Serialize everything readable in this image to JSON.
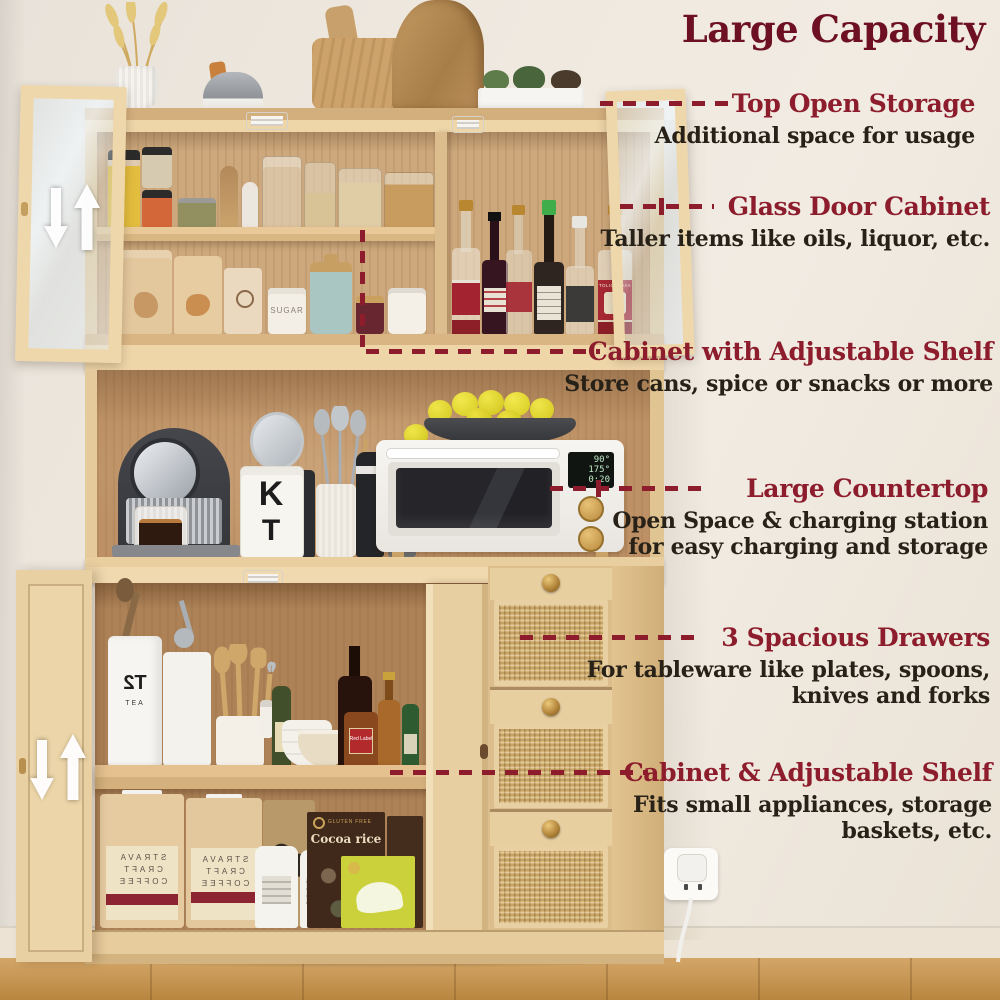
{
  "title": "Large Capacity",
  "annotations": [
    {
      "heading": "Top Open Storage",
      "lines": [
        "Additional space for usage"
      ]
    },
    {
      "heading": "Glass Door Cabinet",
      "lines": [
        "Taller items like oils, liquor, etc."
      ]
    },
    {
      "heading": "Cabinet with Adjustable Shelf",
      "lines": [
        "Store cans, spice or snacks or more"
      ]
    },
    {
      "heading": "Large Countertop",
      "lines": [
        "Open Space & charging station",
        "for easy charging and storage"
      ]
    },
    {
      "heading": "3 Spacious Drawers",
      "lines": [
        "For tableware like plates, spoons,",
        "knives and forks"
      ]
    },
    {
      "heading": "Cabinet & Adjustable Shelf",
      "lines": [
        "Fits small appliances, storage",
        "baskets, etc."
      ]
    }
  ],
  "labels": {
    "sugar_canister": "SUGAR",
    "kt_canister_top": "K",
    "kt_canister_bottom": "T",
    "tea_bag_brand": "T2",
    "tea_bag_sub": "TEA",
    "coffee_bag_lines": [
      "STRAVA",
      "CRAFT",
      "COFFEE"
    ],
    "cocoa_box_tagline": "GLUTEN FREE",
    "cocoa_box_name": "Cocoa rice",
    "whisky_label": "Red Label",
    "vodka_label": "TOLICHNAYA",
    "oven_display": [
      "90°",
      "175°",
      "0:20"
    ]
  },
  "colors": {
    "accent_red": "#8d1d2c",
    "title_red": "#6d1023",
    "body_text": "#272118",
    "wood_light": "#eed7ab",
    "wood_back": "#cda87c",
    "rattan": "#d9b87a",
    "wall": "#ece6dc",
    "floor": "#c89a58"
  }
}
